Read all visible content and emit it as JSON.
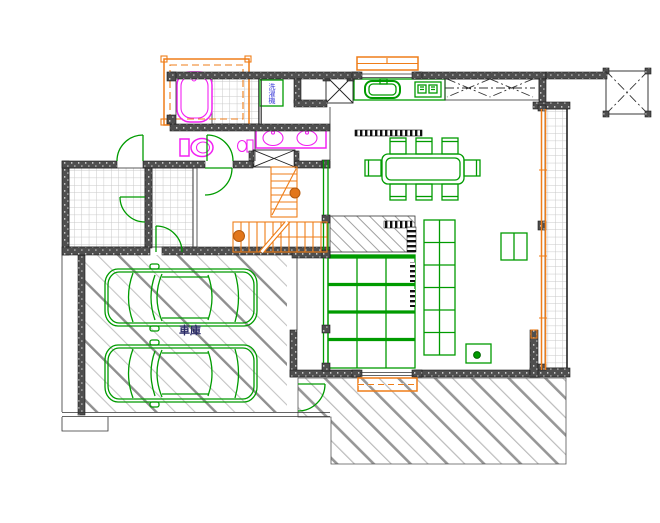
{
  "app": {
    "type": "cad-floor-plan-viewer",
    "background": "#ffffff"
  },
  "labels": {
    "garage": "車庫",
    "washing_machine": "洗濯機"
  },
  "colors": {
    "wall_fill": "#4f4f4f",
    "outline_black": "#1a1a1a",
    "fixture_green": "#009b00",
    "stairs_orange": "#ef7d18",
    "sanitary_magenta": "#f222f2",
    "washer_label_blue": "#3b3bd8",
    "garage_label_navy": "#2a2a66",
    "tile_grid_gray": "#c9c9c9",
    "hatch_gray": "#b5b5b5"
  },
  "elements": [
    "bathtub",
    "shower-fixture",
    "toilet",
    "hand-wash-basin",
    "vanity-double-sink",
    "washing-machine",
    "kitchen-sink",
    "cooktop",
    "dining-table",
    "dining-chairs",
    "wood-deck",
    "shelf-unit",
    "low-table",
    "side-table",
    "stairs",
    "car",
    "car",
    "bay-window",
    "balcony-slider",
    "unit-bath-frame",
    "closet-x-box",
    "void-area"
  ]
}
